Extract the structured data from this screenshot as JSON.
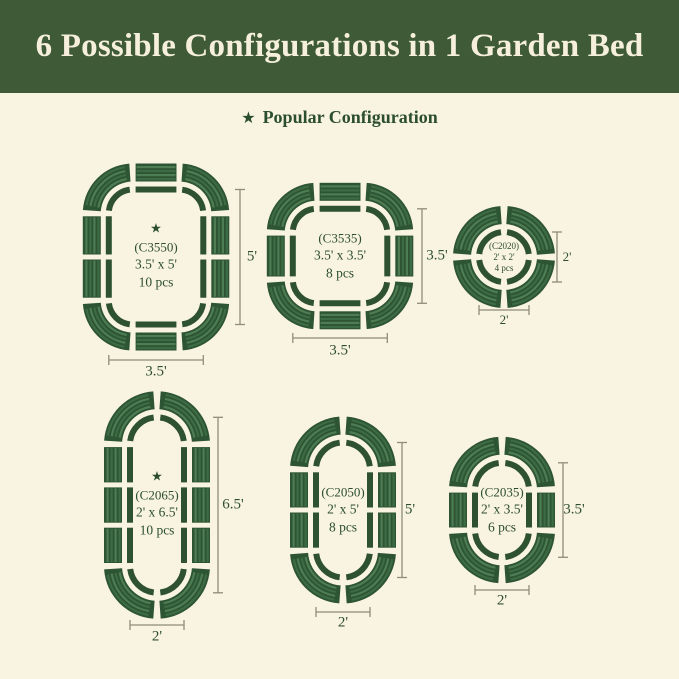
{
  "header": {
    "title": "6 Possible Configurations in 1 Garden Bed"
  },
  "legend": {
    "label": "Popular Configuration"
  },
  "icons": {
    "star": "★"
  },
  "colors": {
    "banner_green": "#3f5a37",
    "background_cream": "#f9f3e2",
    "title_cream": "#f5efdb",
    "dark_green_text": "#2b4e2c",
    "bed_outline_green": "#2e5130",
    "panel_green": "#2d5433",
    "panel_stripe_light": "#4f7d53",
    "dimension_line": "#8e8c7a"
  },
  "configs": [
    {
      "model": "(C3550)",
      "size": "3.5' x 5'",
      "pieces": "10 pcs",
      "popular": true,
      "height_label": "5'",
      "width_label": "3.5'",
      "shape": "rounded-rect",
      "feet": {
        "w": 3.5,
        "h": 5
      },
      "side_segments": 2
    },
    {
      "model": "(C3535)",
      "size": "3.5' x 3.5'",
      "pieces": "8 pcs",
      "popular": false,
      "height_label": "3.5'",
      "width_label": "3.5'",
      "shape": "rounded-rect",
      "feet": {
        "w": 3.5,
        "h": 3.5
      },
      "side_segments": 1
    },
    {
      "model": "(C2020)",
      "size": "2' x 2'",
      "pieces": "4 pcs",
      "popular": false,
      "height_label": "2'",
      "width_label": "2'",
      "shape": "circle",
      "feet": {
        "w": 2,
        "h": 2
      },
      "side_segments": 0
    },
    {
      "model": "(C2065)",
      "size": "2' x 6.5'",
      "pieces": "10 pcs",
      "popular": true,
      "height_label": "6.5'",
      "width_label": "2'",
      "shape": "capsule",
      "feet": {
        "w": 2,
        "h": 6.5
      },
      "side_segments": 3
    },
    {
      "model": "(C2050)",
      "size": "2' x 5'",
      "pieces": "8 pcs",
      "popular": false,
      "height_label": "5'",
      "width_label": "2'",
      "shape": "capsule",
      "feet": {
        "w": 2,
        "h": 5
      },
      "side_segments": 2
    },
    {
      "model": "(C2035)",
      "size": "2' x 3.5'",
      "pieces": "6 pcs",
      "popular": false,
      "height_label": "3.5'",
      "width_label": "2'",
      "shape": "capsule",
      "feet": {
        "w": 2,
        "h": 3.5
      },
      "side_segments": 1
    }
  ]
}
